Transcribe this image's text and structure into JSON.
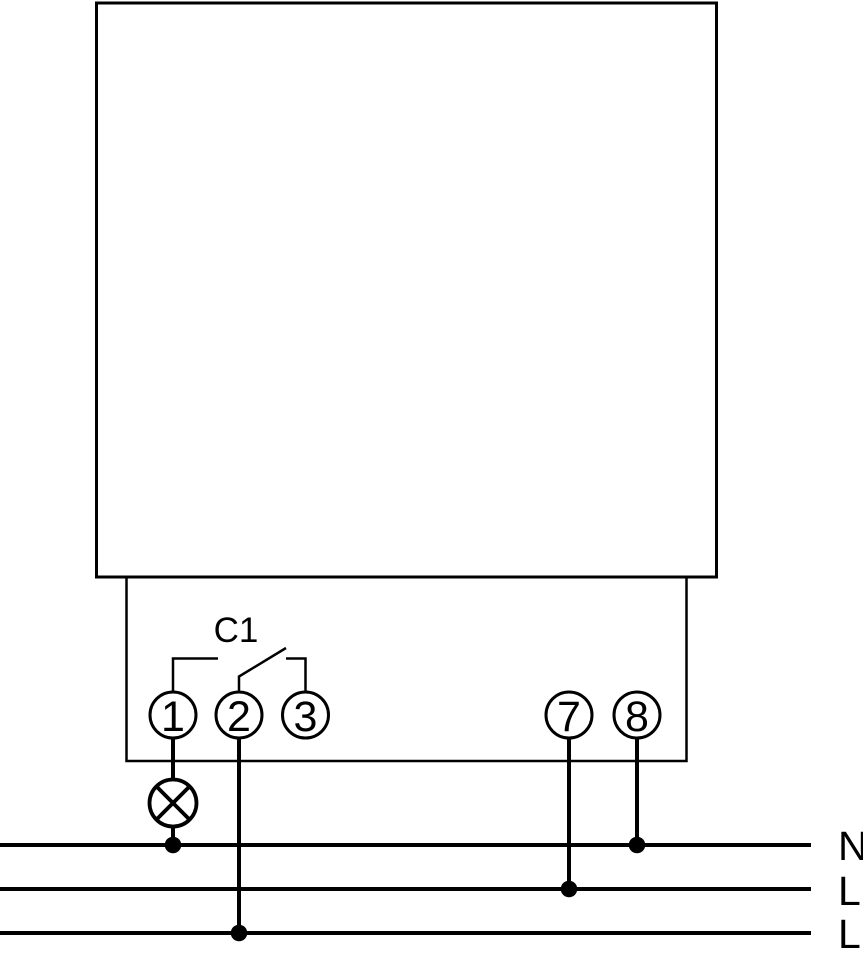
{
  "diagram": {
    "kind": "relay-wiring-schematic",
    "relay_label": "C1",
    "terminals": [
      {
        "label": "1"
      },
      {
        "label": "2"
      },
      {
        "label": "3"
      },
      {
        "label": "7"
      },
      {
        "label": "8"
      }
    ],
    "bus_lines": [
      {
        "label": "N"
      },
      {
        "label": "L"
      },
      {
        "label": "L"
      }
    ],
    "symbols": {
      "load": "lamp-icon",
      "contact": "changeover-switch-contact"
    },
    "colors": {
      "stroke": "#000000",
      "background": "#ffffff"
    }
  }
}
